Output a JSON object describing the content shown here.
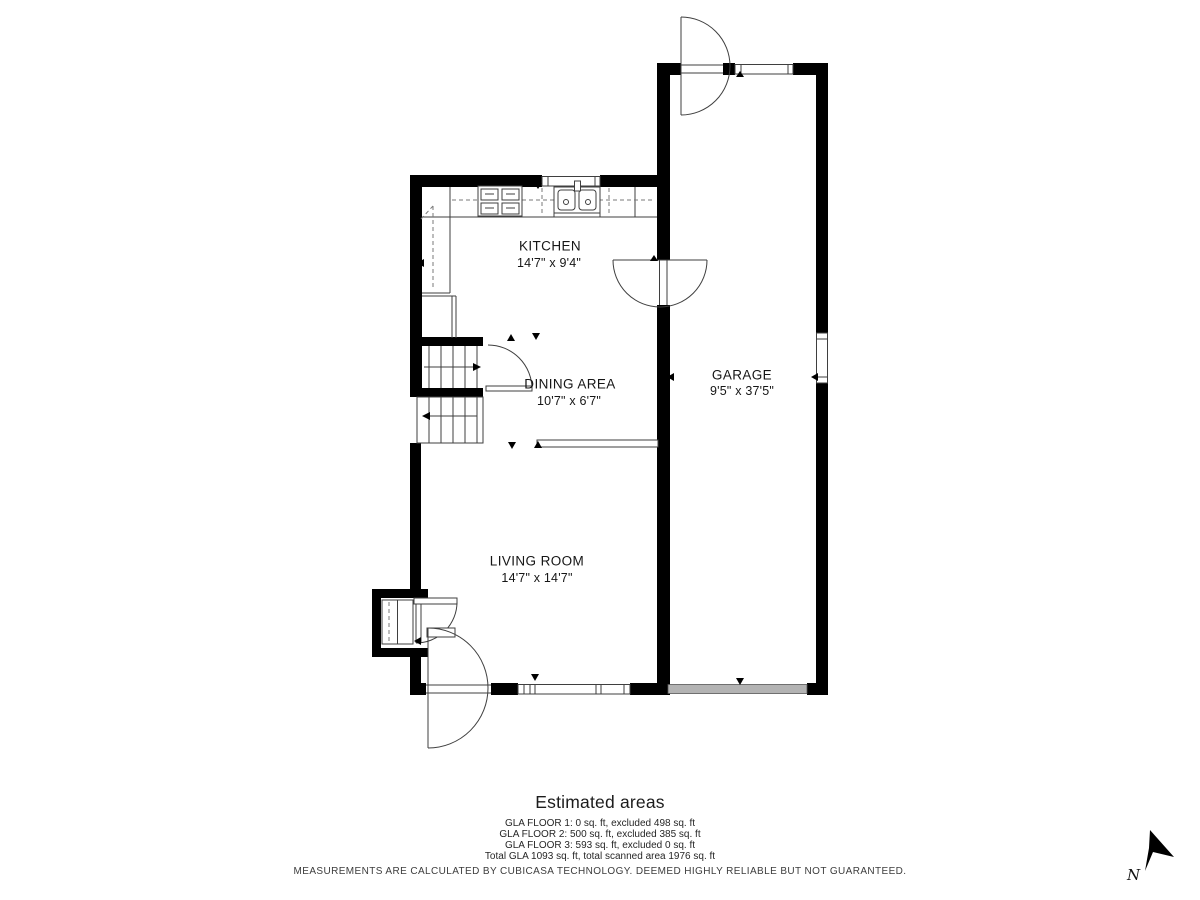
{
  "floorplan": {
    "rooms": [
      {
        "name": "KITCHEN",
        "dimensions": "14'7\" x 9'4\""
      },
      {
        "name": "DINING AREA",
        "dimensions": "10'7\" x 6'7\""
      },
      {
        "name": "GARAGE",
        "dimensions": "9'5\" x 37'5\""
      },
      {
        "name": "LIVING ROOM",
        "dimensions": "14'7\" x 14'7\""
      }
    ],
    "compass_label": "N"
  },
  "estimated_areas": {
    "title": "Estimated areas",
    "lines": [
      "GLA FLOOR 1: 0 sq. ft, excluded 498 sq. ft",
      "GLA FLOOR 2: 500 sq. ft, excluded 385 sq. ft",
      "GLA FLOOR 3: 593 sq. ft, excluded 0 sq. ft",
      "Total GLA 1093 sq. ft, total scanned area 1976 sq. ft"
    ]
  },
  "footer": {
    "disclaimer": "MEASUREMENTS ARE CALCULATED BY CUBICASA TECHNOLOGY. DEEMED HIGHLY RELIABLE BUT NOT GUARANTEED."
  },
  "colors": {
    "wall": "#000000",
    "thin_line": "#3f3f3f",
    "garage_door_fill": "#b3b3b3",
    "label_text": "#161616",
    "muted_text": "#3c3c3c"
  }
}
